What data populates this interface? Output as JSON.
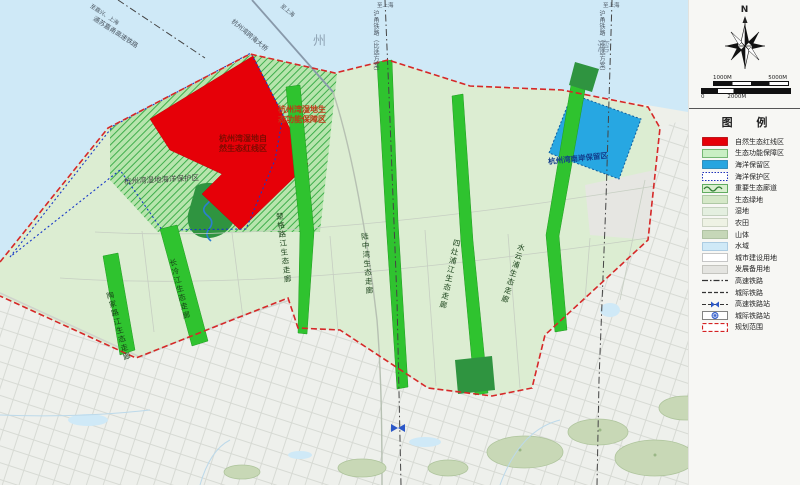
{
  "sea_labels": [
    "州",
    "湾"
  ],
  "zones": {
    "red_line_area": {
      "line1": "杭州湾湿地自",
      "line2": "然生态红线区"
    },
    "eco_function_area": {
      "line1": "杭州湾湿地生",
      "line2": "态功能保障区"
    },
    "marine_protected_area": "杭州湾湿地海洋保护区",
    "marine_reserve_area": "杭州湾南岸保留区"
  },
  "corridors": [
    "陶家路江生态走廊",
    "长冷江生态走廊",
    "楚格路江生态走廊",
    "陆中湾生态走廊",
    "四灶浦江生态走廊",
    "水云浦生态走廊"
  ],
  "railways": [
    {
      "label": "通苏嘉甬高速铁路",
      "note": "至嘉兴、上海"
    },
    {
      "label": "杭州湾跨海大桥",
      "note": "至上海"
    },
    {
      "label": "沪甬铁路（比选方案）",
      "note": "至上海"
    },
    {
      "label": "沪甬铁路（比选方案）",
      "note": "至上海"
    }
  ],
  "compass": {
    "north_label": "N"
  },
  "scalebar": {
    "top_left": "1000M",
    "top_right": "5000M",
    "bottom_left": "0",
    "bottom_mid": "2000M"
  },
  "legend": {
    "title": "图 例",
    "items": [
      {
        "label": "自然生态红线区",
        "type": "solid",
        "bg": "#e60008",
        "border": "#b00006"
      },
      {
        "label": "生态功能保障区",
        "type": "solid",
        "bg": "#c9efc4",
        "border": "#5aa85a"
      },
      {
        "label": "海洋保留区",
        "type": "solid",
        "bg": "#27a5e0",
        "border": "#1b7fb0"
      },
      {
        "label": "海洋保护区",
        "type": "dotted",
        "bg": "#ffffff",
        "border": "#2233bb"
      },
      {
        "label": "重要生态廊道",
        "type": "wave",
        "bg": "#d9efcf",
        "border": "#3f9a3f",
        "accent": "#2e7d32"
      },
      {
        "label": "生态绿地",
        "type": "solid",
        "bg": "#d5e8c8",
        "border": "#9fbf97"
      },
      {
        "label": "湿地",
        "type": "solid",
        "bg": "#e4efe0",
        "border": "#b9c9b4"
      },
      {
        "label": "农田",
        "type": "solid",
        "bg": "#eef2e4",
        "border": "#c4ccba"
      },
      {
        "label": "山体",
        "type": "solid",
        "bg": "#c6d7b8",
        "border": "#a3b896"
      },
      {
        "label": "水域",
        "type": "solid",
        "bg": "#cfe9f7",
        "border": "#9fc4dd"
      },
      {
        "label": "城市建设用地",
        "type": "solid",
        "bg": "#ffffff",
        "border": "#b9b9b9"
      },
      {
        "label": "发展备用地",
        "type": "solid",
        "bg": "#e4e4e0",
        "border": "#b9b9b4"
      },
      {
        "label": "高速铁路",
        "type": "dashdot",
        "line": "#333333"
      },
      {
        "label": "城际铁路",
        "type": "dash",
        "line": "#333333"
      },
      {
        "label": "高速铁路站",
        "type": "hsr-station",
        "line": "#333333",
        "accent": "#2b57c8"
      },
      {
        "label": "城际铁路站",
        "type": "icr-station",
        "border": "#666666",
        "accent": "#2b57c8"
      },
      {
        "label": "规划范围",
        "type": "red-dash",
        "border": "#d42222"
      }
    ]
  },
  "colors": {
    "sea": "#cfe9f7",
    "land": "#eef0ea",
    "planning_area": "#dcedd2",
    "wetland_hatch": "#3fae4c",
    "red_line_zone": "#e60008",
    "marine_reserve_zone": "#27a7e2",
    "corridor_green": "#2fc32f",
    "dense_green": "#2f9440",
    "boundary_red": "#d62828",
    "mountain": "#c8d8b6"
  }
}
